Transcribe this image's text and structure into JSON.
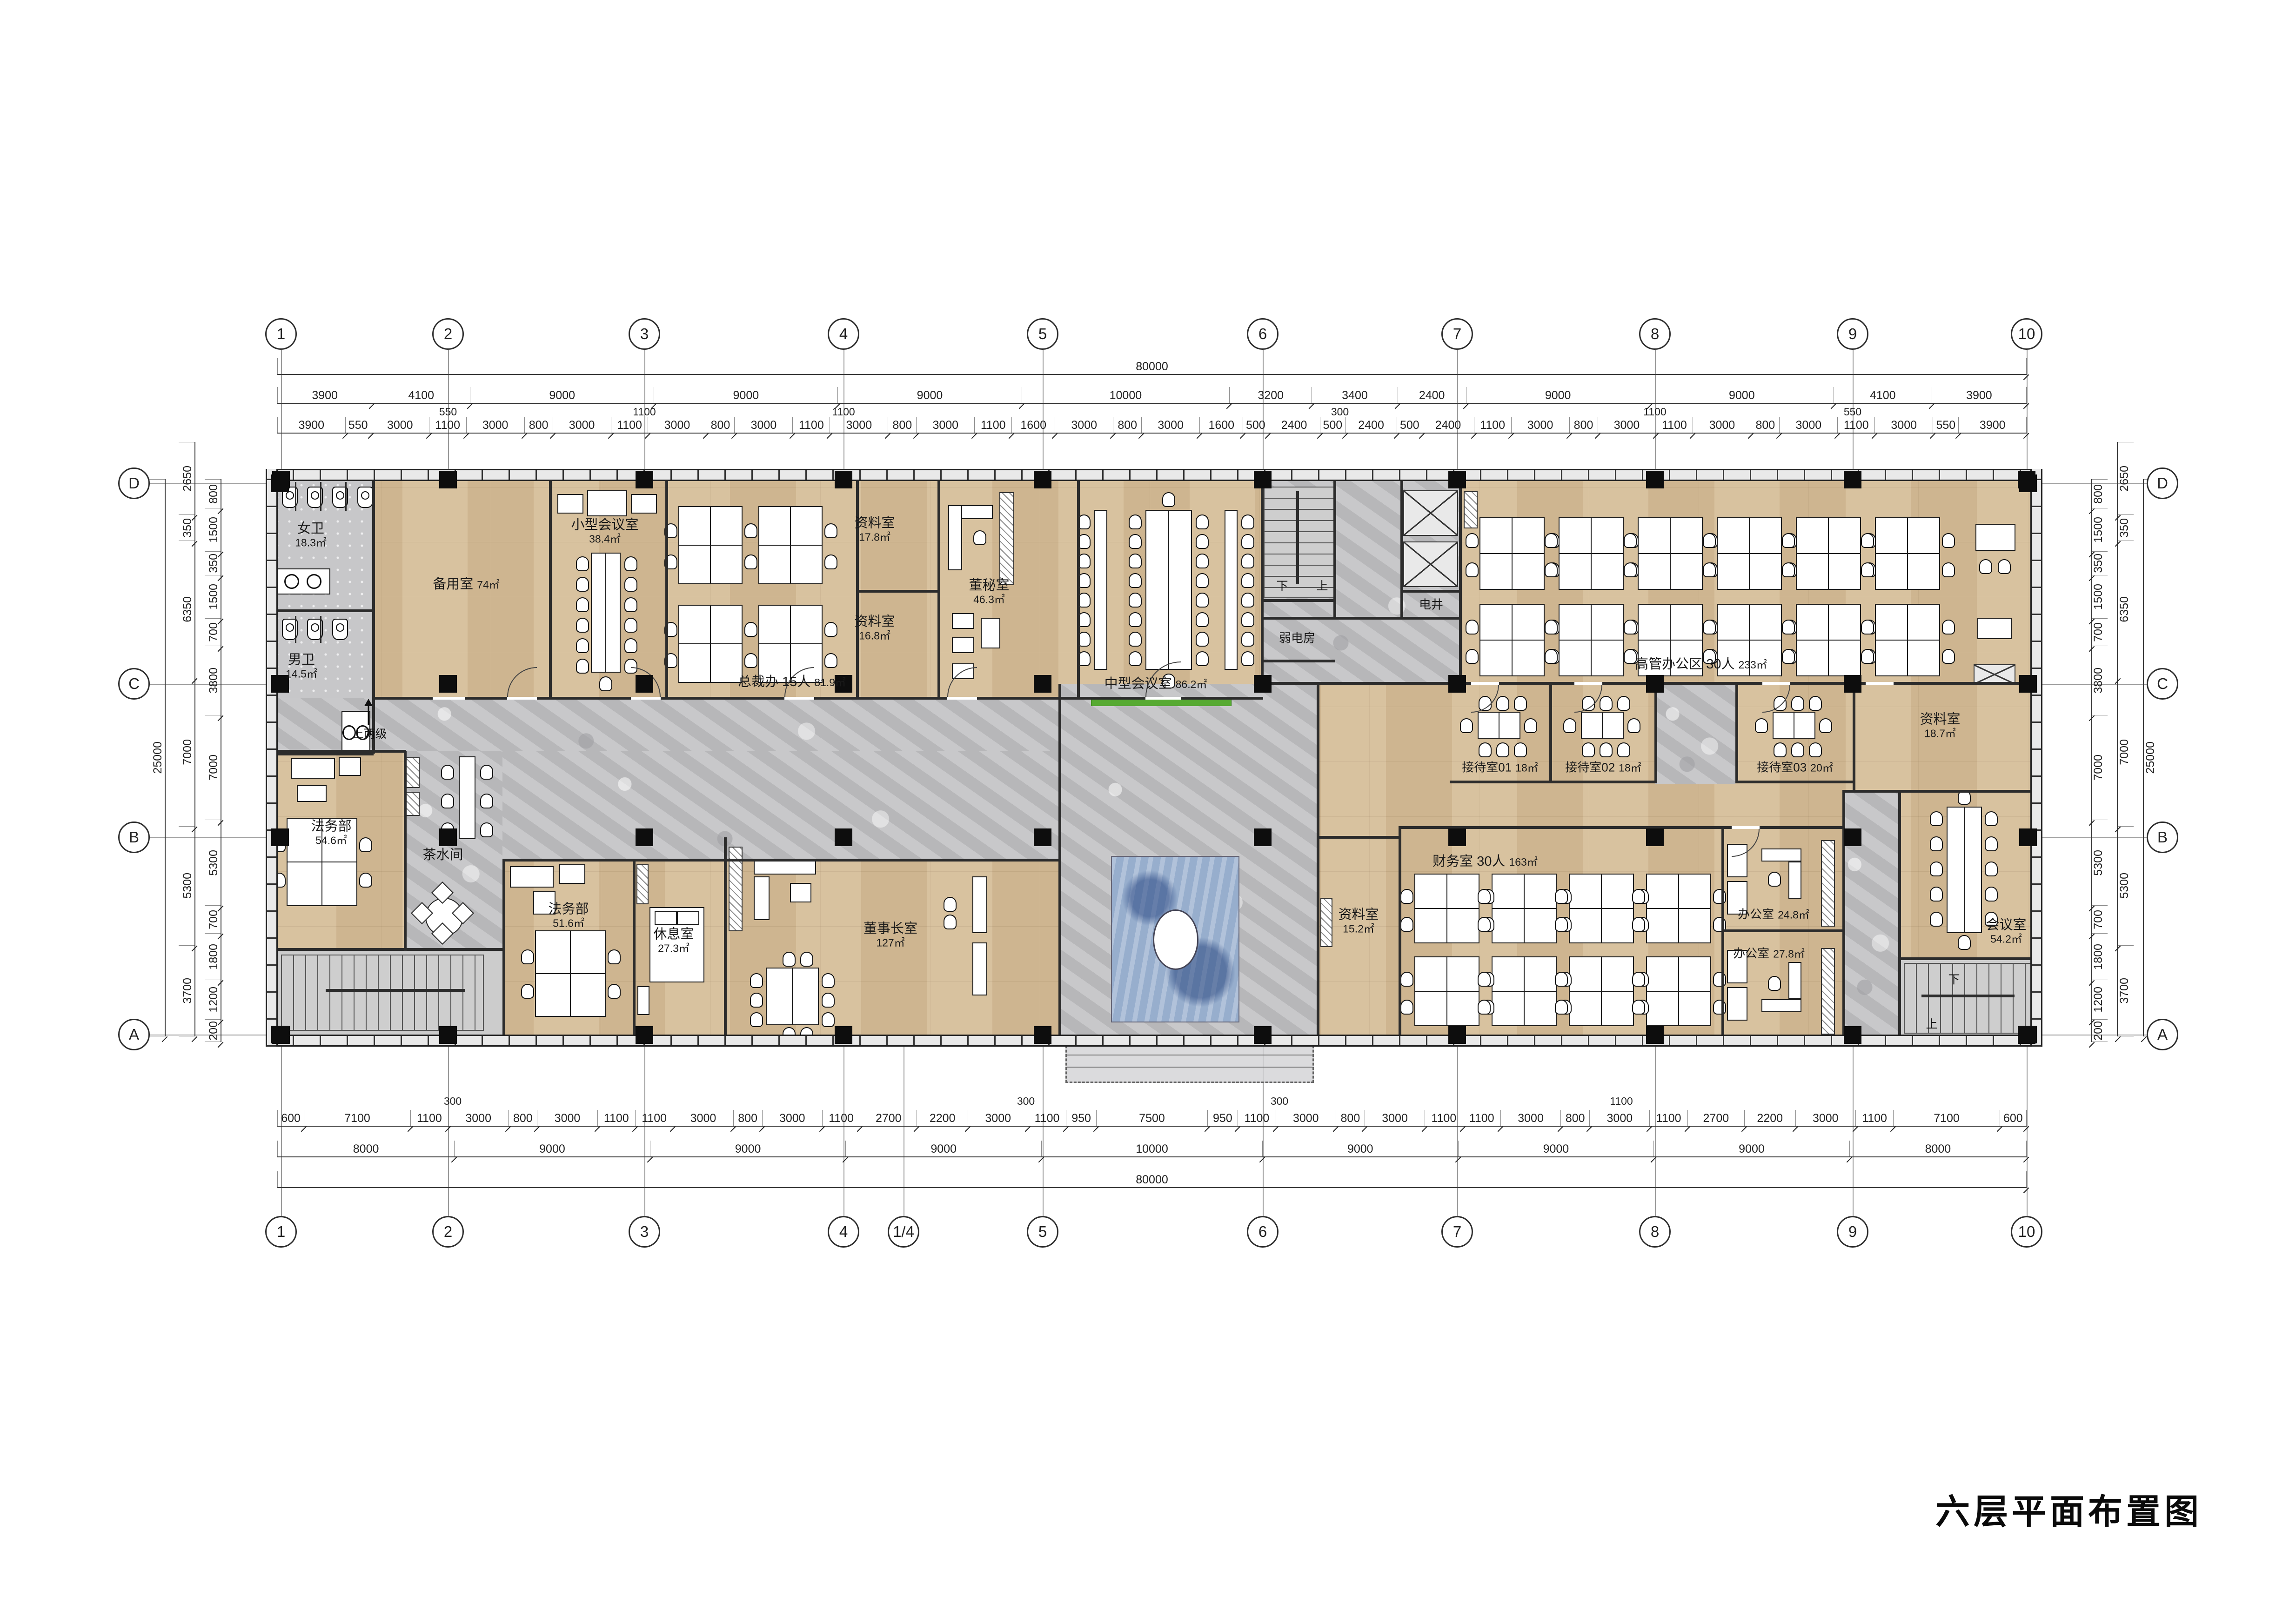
{
  "title": "六层平面布置图",
  "grid": {
    "cols_top": [
      "1",
      "2",
      "3",
      "4",
      "5",
      "6",
      "7",
      "8",
      "9",
      "10"
    ],
    "cols_bottom": [
      "1",
      "2",
      "3",
      "4",
      "1/4",
      "5",
      "6",
      "7",
      "8",
      "9",
      "10"
    ],
    "rows_left": [
      "D",
      "C",
      "B",
      "A"
    ],
    "rows_right": [
      "D",
      "C",
      "B",
      "A"
    ]
  },
  "dimensions": {
    "overall_width": "80000",
    "overall_height": "25000",
    "top_main": [
      "3900",
      "4100",
      "9000",
      "9000",
      "9000",
      "10000",
      "3200",
      "3400",
      "2400",
      "9000",
      "9000",
      "4100",
      "3900"
    ],
    "top_main_offsets": [
      "550",
      "1100",
      "1100",
      "300",
      "1100",
      "550"
    ],
    "top_detail": [
      "3900",
      "550",
      "3000",
      "1100",
      "3000",
      "800",
      "3000",
      "1100",
      "3000",
      "800",
      "3000",
      "1100",
      "3000",
      "800",
      "3000",
      "1100",
      "1600",
      "3000",
      "800",
      "3000",
      "1600",
      "500",
      "2400",
      "500",
      "2400",
      "500",
      "2400",
      "1100",
      "3000",
      "800",
      "3000",
      "1100",
      "3000",
      "800",
      "3000",
      "1100",
      "3000",
      "550",
      "3900"
    ],
    "bottom_main": [
      "8000",
      "9000",
      "9000",
      "9000",
      "10000",
      "9000",
      "9000",
      "9000",
      "8000"
    ],
    "bottom_detail": [
      "600",
      "7100",
      "1100",
      "3000",
      "800",
      "3000",
      "1100",
      "1100",
      "3000",
      "800",
      "3000",
      "1100",
      "2700",
      "2200",
      "3000",
      "1100",
      "950",
      "7500",
      "950",
      "1100",
      "3000",
      "800",
      "3000",
      "1100",
      "1100",
      "3000",
      "800",
      "3000",
      "1100",
      "2700",
      "2200",
      "3000",
      "1100",
      "7100",
      "600"
    ],
    "bottom_offsets": [
      "300",
      "300",
      "300",
      "1100"
    ],
    "left_main": [
      "2650",
      "350",
      "6350",
      "7000",
      "5300",
      "3700"
    ],
    "left_detail": [
      "800",
      "1500",
      "350",
      "1500",
      "700",
      "3800",
      "7000",
      "5300",
      "700",
      "1800",
      "1200",
      "200"
    ],
    "right_main": [
      "2650",
      "350",
      "6350",
      "7000",
      "5300",
      "3700"
    ],
    "right_detail": [
      "800",
      "1500",
      "350",
      "1500",
      "700",
      "3800",
      "7000",
      "5300",
      "700",
      "1800",
      "1200",
      "200"
    ]
  },
  "rooms": {
    "wc_women": {
      "name": "女卫",
      "area": "18.3㎡"
    },
    "wc_men": {
      "name": "男卫",
      "area": "14.5㎡"
    },
    "backup": {
      "name": "备用室",
      "area": "74㎡"
    },
    "small_meeting": {
      "name": "小型会议室",
      "area": "38.4㎡"
    },
    "ceo": {
      "name": "总裁办 15人",
      "area": "81.9㎡"
    },
    "archive1": {
      "name": "资料室",
      "area": "17.8㎡"
    },
    "archive2": {
      "name": "资料室",
      "area": "16.8㎡"
    },
    "secretary": {
      "name": "董秘室",
      "area": "46.3㎡"
    },
    "mid_meeting": {
      "name": "中型会议室",
      "area": "86.2㎡"
    },
    "weak_current": {
      "name": "弱电房",
      "area": ""
    },
    "elec_shaft": {
      "name": "电井",
      "area": ""
    },
    "exec_area": {
      "name": "高管办公区 30人",
      "area": "233㎡"
    },
    "reception1": {
      "name": "接待室01",
      "area": "18㎡"
    },
    "reception2": {
      "name": "接待室02",
      "area": "18㎡"
    },
    "reception3": {
      "name": "接待室03",
      "area": "20㎡"
    },
    "archive3": {
      "name": "资料室",
      "area": "18.7㎡"
    },
    "legal1": {
      "name": "法务部",
      "area": "54.6㎡"
    },
    "tea": {
      "name": "茶水间",
      "area": ""
    },
    "legal2": {
      "name": "法务部",
      "area": "51.6㎡"
    },
    "lounge": {
      "name": "休息室",
      "area": "27.3㎡"
    },
    "chairman": {
      "name": "董事长室",
      "area": "127㎡"
    },
    "archive4": {
      "name": "资料室",
      "area": "15.2㎡"
    },
    "finance": {
      "name": "财务室 30人",
      "area": "163㎡"
    },
    "office1": {
      "name": "办公室",
      "area": "24.8㎡"
    },
    "office2": {
      "name": "办公室",
      "area": "27.8㎡"
    },
    "meeting2": {
      "name": "会议室",
      "area": "54.2㎡"
    }
  },
  "annotations": {
    "steps": "上两级",
    "stair_down": "下",
    "stair_up": "上"
  }
}
